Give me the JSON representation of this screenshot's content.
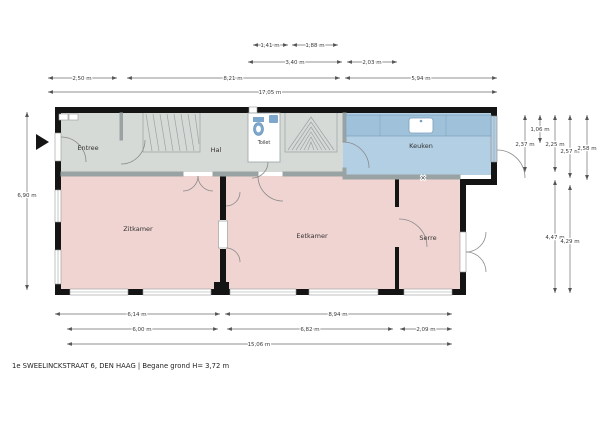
{
  "footer": {
    "text": "1e SWEELINCKSTRAAT 6, DEN HAAG | Begane grond H= 3,72 m"
  },
  "rooms": {
    "entree": "Entree",
    "hal": "Hal",
    "toilet": "Toilet",
    "keuken": "Keuken",
    "zitkamer": "Zitkamer",
    "eetkamer": "Eetkamer",
    "serre": "Serre"
  },
  "symbols": {
    "cross": "×"
  },
  "dimensions": {
    "top": [
      "1,41 m",
      "1,88 m",
      "3,40 m",
      "2,03 m",
      "2,50 m",
      "8,21 m",
      "5,94 m",
      "17,05 m"
    ],
    "bottom": [
      "6,14 m",
      "8,94 m",
      "6,00 m",
      "6,82 m",
      "2,09 m",
      "15,06 m"
    ],
    "left": [
      "6,90 m"
    ],
    "right": [
      "2,37 m",
      "1,06 m",
      "2,25 m",
      "4,47 m",
      "2,57 m",
      "4,29 m",
      "2,58 m"
    ]
  },
  "colors": {
    "wall": "#141414",
    "room_grey": "#d6dad6",
    "room_pink": "#f0d4d1",
    "room_blue": "#b3cfe4",
    "counter_blue": "#9fc2da",
    "fixture_blue": "#7da7cc"
  }
}
